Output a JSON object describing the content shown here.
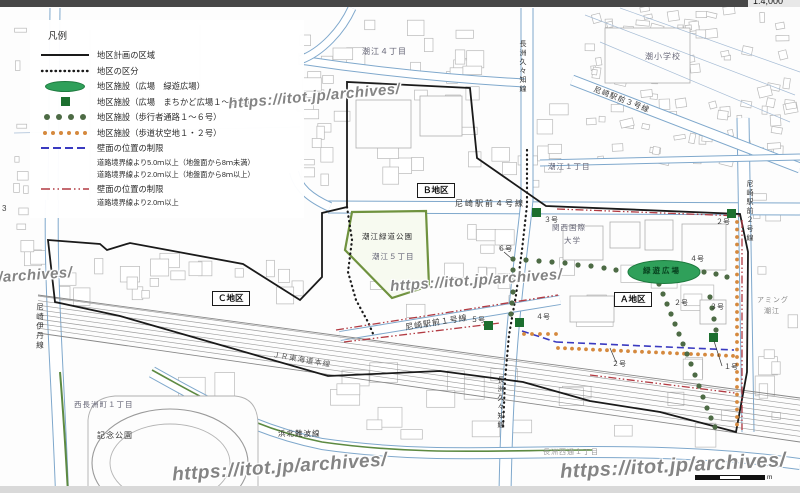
{
  "page": {
    "scale_note": "1:4,000",
    "side_number": "3",
    "scalebar_unit": "m"
  },
  "legend": {
    "title": "凡例",
    "items": [
      {
        "symbol": "solid-black-line",
        "label": "地区計画の区域"
      },
      {
        "symbol": "dotted-black-line",
        "label": "地区の区分"
      },
      {
        "symbol": "green-ellipse",
        "label": "地区施設（広場　緑遊広場）"
      },
      {
        "symbol": "green-square",
        "label": "地区施設（広場　まちかど広場１～５号）"
      },
      {
        "symbol": "green-dots",
        "label": "地区施設（歩行者通路１～６号）"
      },
      {
        "symbol": "orange-dots",
        "label": "地区施設（歩道状空地１・２号）"
      },
      {
        "symbol": "blue-dashed-line",
        "label": "壁面の位置の制限",
        "sub1": "道路境界線より5.0ｍ以上（地盤面から8ｍ未満）",
        "sub2": "道路境界線より2.0ｍ以上（地盤面から8ｍ以上）"
      },
      {
        "symbol": "red-dashdot-line",
        "label": "壁面の位置の制限",
        "sub1": "道路境界線より2.0ｍ以上"
      }
    ],
    "colors": {
      "plaza_green": "#2fa05a",
      "plaza_green_dark": "#1d7a3e",
      "square_green": "#1c6f2f",
      "path_dot_green": "#4d6b45",
      "walkway_dot_orange": "#d5893e",
      "wall_blue": "#3a3ac0",
      "wall_red": "#b23a42",
      "boundary_black": "#1a1a1a"
    }
  },
  "districts": {
    "a": "Ａ地区",
    "b": "Ｂ地区",
    "c": "Ｃ地区"
  },
  "roads": {
    "ekimae1": "尼崎駅前１号線",
    "ekimae2": "尼崎駅前２号線",
    "ekimae3": "尼崎駅前３号線",
    "ekimae4": "尼崎駅前４号線",
    "itami": "尼崎伊丹線",
    "kukuchi": "長洲久々知線",
    "hamakita": "浜北難波線",
    "jr_tokaido": "ＪＲ東海道本線"
  },
  "places": {
    "ushio_elementary": "潮小学校",
    "shioe_4chome": "潮江４丁目",
    "shioe_1chome": "潮江１丁目",
    "shioe_5chome": "潮江５丁目",
    "ryokudo_park": "潮江緑道公園",
    "nishinagasu_1chome": "西長洲町１丁目",
    "kinen_park": "記念公園",
    "kansai_univ_line1": "関西国際",
    "kansai_univ_line2": "大学",
    "ryokuyu_plaza": "緑遊広場",
    "aming_line1": "アミング",
    "aming_line2": "潮江",
    "nagasu_nishidori": "長洲西通１丁目"
  },
  "facility_numbers": {
    "path6": "６号",
    "path4": "４号",
    "path2": "２号",
    "path3": "３号",
    "path2b": "２号",
    "square1": "１号",
    "square2": "２号",
    "square3": "３号",
    "square4": "４号",
    "square5": "５号"
  },
  "watermark": {
    "url": "https://itot.jp/archives/"
  }
}
